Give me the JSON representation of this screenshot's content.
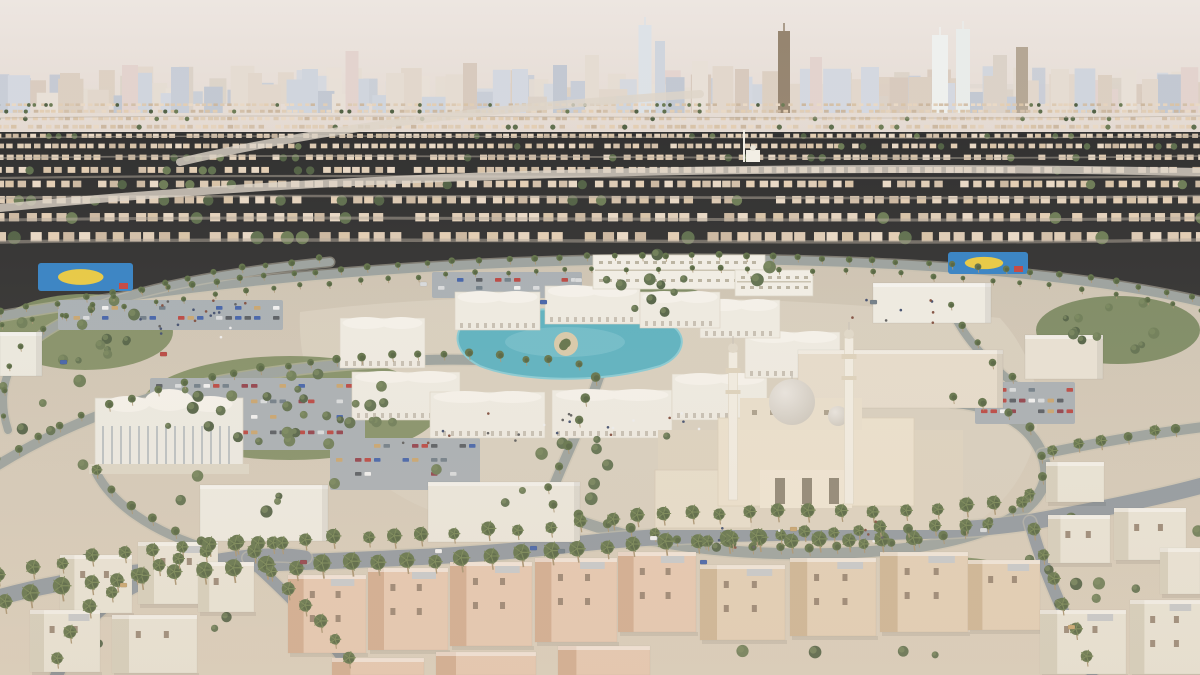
{
  "meta": {
    "description": "Aerial 3D architectural rendering of a Middle-Eastern city district: a community core with a grand mosque, arcaded souq around a turquoise pool, schools, parks, parking lots and palm-lined ring roads, surrounded by low-rise residential sprawl and a high-rise skyline on the horizon",
    "visible_text": "none"
  },
  "palette": {
    "sky_top": "#ede6e1",
    "sky_bot": "#e4dad2",
    "haze": "#ded7cf",
    "skyline": [
      "#c8cdd7",
      "#d4d8e0",
      "#dbd2c8",
      "#e2d7cc",
      "#cfd5dd",
      "#d8cabd",
      "#e5dcd2",
      "#c2c8d2",
      "#dccfc2",
      "#e8e0d7",
      "#e3d3ce"
    ],
    "sand_houses": [
      "#dcc9b2",
      "#e5d3bd",
      "#d2bfa8",
      "#e9d9c5",
      "#cbb79f",
      "#e0cdb6",
      "#d7c2a6",
      "#e3cdb2"
    ],
    "sprawl_street": "#b3aa9b",
    "sprawl_highway": "#ddd5c8",
    "ground_top": "#cdc3b2",
    "ground_bot": "#dbcfbc",
    "plaza": "#d8cfbf",
    "road": "#99a09c",
    "road_fg": "#8f979e",
    "road_edge": "#c6bfae",
    "green": [
      "#75855c",
      "#7d8b60"
    ],
    "tree": [
      "#4e5e41",
      "#5b6c4a",
      "#697952"
    ],
    "tree_hi": "#76865a",
    "palm_crown": "#5d6f45",
    "palm_crown_dark": "#4b5b38",
    "palm_frond": "#71824f",
    "palm_trunk": "#a8926f",
    "pool": "#57b0c0",
    "pool_light": "#84cad4",
    "island_sand": "#d8c9a8",
    "court_blue": "#2f7fc4",
    "court_yellow": "#e8c93e",
    "court_red": "#c2403a",
    "white_b": "#efece3",
    "white_roof": "#f6f3ec",
    "arcade_dark": "#b5ad9c",
    "school_face": "#f2efe7",
    "school_line": "#c9c2b0",
    "mosque_wall": "#ece1cd",
    "mosque_plat": "#ddd2bf",
    "mosque_court": "#e8decb",
    "mosque_dark": "#8d8372",
    "dome_hi": "#e9e5df",
    "dome_lo": "#c9c3b8",
    "minaret": "#f2ede2",
    "minaret_trim": "#ddd2bc",
    "villa_white": "#eae5d7",
    "villa_white_side": "#d6cfbc",
    "villa_pink": "#e7c8b0",
    "villa_pink_side": "#d2ab8e",
    "villa_beige": "#e4cfb5",
    "villa_beige_side": "#ceb493",
    "roofdeck": "#c6c9cb",
    "window": "#8a7663",
    "parking": "#a7aeb3",
    "cars": [
      "#d8dbdd",
      "#b8413c",
      "#3d5ea8",
      "#53585e",
      "#c8a36b",
      "#f2f2f2",
      "#6c7a85",
      "#8e3b46"
    ],
    "people": [
      "#5a5a5a",
      "#7d4a3a",
      "#3c4a6b",
      "#efefef"
    ]
  },
  "scene": {
    "seed": 11,
    "skyline": {
      "bands": [
        {
          "base": 104,
          "step": [
            12,
            24
          ],
          "w": [
            10,
            24
          ],
          "h": [
            12,
            38
          ]
        },
        {
          "base": 113,
          "step": [
            16,
            30
          ],
          "w": [
            14,
            30
          ],
          "h": [
            16,
            48
          ]
        }
      ],
      "towers": [
        [
          70,
          20,
          40
        ],
        [
          130,
          16,
          48
        ],
        [
          180,
          18,
          46
        ],
        [
          255,
          14,
          40
        ],
        [
          310,
          16,
          44
        ],
        [
          352,
          13,
          62
        ],
        [
          395,
          18,
          40
        ],
        [
          470,
          14,
          50
        ],
        [
          520,
          16,
          44
        ],
        [
          560,
          14,
          48
        ],
        [
          592,
          14,
          58
        ],
        [
          645,
          13,
          88,
          "#dde2e7"
        ],
        [
          660,
          10,
          72
        ],
        [
          700,
          16,
          52
        ],
        [
          742,
          14,
          44
        ],
        [
          784,
          12,
          82,
          "#95846f"
        ],
        [
          816,
          12,
          56
        ],
        [
          870,
          18,
          46
        ],
        [
          940,
          16,
          78,
          "#eef0ee"
        ],
        [
          963,
          14,
          84,
          "#e9ecea"
        ],
        [
          1000,
          14,
          58
        ],
        [
          1022,
          12,
          66,
          "#b4a694"
        ],
        [
          1060,
          18,
          44
        ],
        [
          1105,
          14,
          38
        ],
        [
          1150,
          16,
          34
        ]
      ],
      "haze_band": [
        760,
        84,
        440,
        26
      ]
    },
    "sprawl": {
      "y0": 106,
      "y1": 256,
      "streets": [
        118,
        138,
        158,
        178,
        198,
        220,
        242
      ],
      "highways": [
        "M180,162 C350,122 520,106 700,94",
        "M0,208 C300,178 700,162 1200,172"
      ],
      "mini_mosque": [
        746,
        150
      ]
    },
    "ground_d": "M0,322 C250,270 520,254 760,258 C980,262 1120,280 1200,302 L1200,675 L0,675 Z",
    "plaza_d": "M300,312 C480,288 760,292 1000,318 C1058,382 1048,470 980,520 C820,558 600,548 440,514 C340,480 296,390 300,312 Z",
    "parks": [
      [
        85,
        332,
        88,
        38
      ],
      [
        290,
        408,
        150,
        52
      ],
      [
        1118,
        330,
        82,
        34
      ],
      [
        950,
        577,
        70,
        20
      ],
      [
        640,
        300,
        70,
        16
      ]
    ],
    "tree_zones": [
      [
        40,
        540,
        230,
        120,
        10
      ],
      [
        690,
        545,
        320,
        110,
        12
      ],
      [
        1020,
        470,
        180,
        160,
        12
      ],
      [
        180,
        470,
        160,
        70,
        6
      ],
      [
        420,
        452,
        180,
        56,
        6
      ],
      [
        600,
        250,
        190,
        36,
        8
      ],
      [
        0,
        378,
        90,
        90,
        6
      ],
      [
        560,
        430,
        130,
        40,
        5
      ]
    ],
    "roads": [
      {
        "d": "M-10,318 C250,272 520,256 760,260 C980,264 1120,282 1210,304",
        "w": 9
      },
      {
        "d": "M330,262 C150,280 60,310 18,355 C-2,382 2,412 8,430",
        "w": 8
      },
      {
        "d": "M-10,470 C100,400 220,372 380,362 C480,356 540,362 600,374",
        "w": 10
      },
      {
        "d": "M600,374 C585,420 562,462 546,506",
        "w": 10
      },
      {
        "d": "M546,506 C620,546 760,562 890,550 C1000,540 1062,502 1042,454 C1028,420 992,406 952,402",
        "w": 11
      },
      {
        "d": "M1042,454 C1100,442 1160,432 1212,426",
        "w": 10
      },
      {
        "d": "M948,300 C958,332 988,366 1030,396",
        "w": 8
      },
      {
        "d": "M95,470 C110,502 150,532 212,550",
        "w": 9
      },
      {
        "d": "M-10,600 C150,552 350,570 560,546 C760,522 900,542 1030,522 C1120,506 1180,492 1215,482",
        "w": 16,
        "fg": true
      },
      {
        "d": "M55,680 C75,625 110,586 190,566 C240,554 280,553 305,557",
        "w": 13,
        "fg": true
      },
      {
        "d": "M1030,522 C1040,560 1062,612 1092,672",
        "w": 12,
        "fg": true
      },
      {
        "d": "M248,558 C292,598 332,638 354,676",
        "w": 11,
        "fg": true
      }
    ],
    "parking": [
      [
        150,
        378,
        215,
        72,
        4
      ],
      [
        58,
        300,
        225,
        30,
        2
      ],
      [
        432,
        272,
        150,
        26,
        2
      ],
      [
        975,
        382,
        100,
        42,
        3
      ],
      [
        330,
        438,
        150,
        52,
        3
      ]
    ],
    "courts": [
      [
        38,
        263,
        95,
        28
      ],
      [
        948,
        252,
        80,
        22
      ]
    ],
    "pool": {
      "d": "M470,318 C520,306 600,306 660,320 C692,330 686,356 660,366 C600,384 520,382 480,366 C452,352 452,330 470,318 Z",
      "island": [
        566,
        344,
        12
      ]
    },
    "souq": [
      [
        340,
        318,
        85,
        50
      ],
      [
        352,
        372,
        108,
        48
      ],
      [
        430,
        392,
        115,
        46
      ],
      [
        552,
        390,
        120,
        48
      ],
      [
        672,
        374,
        95,
        46
      ],
      [
        745,
        332,
        95,
        46
      ],
      [
        700,
        300,
        80,
        38
      ],
      [
        455,
        292,
        85,
        38
      ],
      [
        545,
        286,
        95,
        38
      ],
      [
        640,
        292,
        80,
        36
      ]
    ],
    "buildings": [
      {
        "r": [
          593,
          255,
          172,
          34
        ],
        "t": "school"
      },
      {
        "r": [
          735,
          270,
          78,
          26
        ],
        "t": "school"
      },
      {
        "r": [
          873,
          283,
          118,
          40
        ],
        "t": "box",
        "c": "#efece3"
      },
      {
        "r": [
          798,
          350,
          205,
          58
        ],
        "t": "box",
        "c": "#e6dccb"
      },
      {
        "r": [
          1025,
          335,
          78,
          44
        ],
        "t": "box",
        "c": "#e9e2d4"
      },
      {
        "r": [
          95,
          398,
          148,
          72
        ],
        "t": "civic"
      },
      {
        "r": [
          200,
          485,
          128,
          56
        ],
        "t": "box",
        "c": "#efece2"
      },
      {
        "r": [
          428,
          482,
          152,
          60
        ],
        "t": "box",
        "c": "#ece8dd"
      },
      {
        "r": [
          660,
          444,
          30,
          22
        ],
        "t": "box",
        "c": "#e8e2d4"
      },
      {
        "r": [
          0,
          332,
          42,
          44
        ],
        "t": "box",
        "c": "#eceae0"
      }
    ],
    "mosque": {
      "platform": [
        658,
        430,
        305,
        100
      ],
      "court": [
        655,
        470,
        96,
        58
      ],
      "hall": [
        718,
        418,
        196,
        88
      ],
      "facade": [
        760,
        470,
        92,
        38
      ],
      "upper": [
        740,
        398,
        122,
        32
      ],
      "dome": [
        792,
        402,
        23
      ],
      "half_dome": [
        838,
        416,
        10
      ],
      "minarets": [
        [
          733,
          352,
          148
        ],
        [
          849,
          338,
          166
        ]
      ]
    },
    "villas": [
      {
        "r": [
          60,
          555,
          72,
          58
        ],
        "t": "white"
      },
      {
        "r": [
          138,
          542,
          80,
          62
        ],
        "t": "white"
      },
      {
        "r": [
          30,
          610,
          70,
          62
        ],
        "t": "white"
      },
      {
        "r": [
          112,
          615,
          85,
          58
        ],
        "t": "white"
      },
      {
        "r": [
          198,
          562,
          56,
          50
        ],
        "t": "white"
      },
      {
        "r": [
          288,
          575,
          78,
          78
        ],
        "t": "pink"
      },
      {
        "r": [
          368,
          568,
          80,
          82
        ],
        "t": "pink"
      },
      {
        "r": [
          450,
          562,
          82,
          84
        ],
        "t": "pink"
      },
      {
        "r": [
          535,
          558,
          82,
          84
        ],
        "t": "pink"
      },
      {
        "r": [
          618,
          552,
          78,
          80
        ],
        "t": "pink"
      },
      {
        "r": [
          332,
          658,
          92,
          17
        ],
        "t": "pink"
      },
      {
        "r": [
          436,
          652,
          100,
          23
        ],
        "t": "pink"
      },
      {
        "r": [
          558,
          646,
          92,
          29
        ],
        "t": "pink"
      },
      {
        "r": [
          700,
          565,
          85,
          75
        ],
        "t": "beige"
      },
      {
        "r": [
          790,
          558,
          86,
          78
        ],
        "t": "beige"
      },
      {
        "r": [
          880,
          552,
          88,
          80
        ],
        "t": "beige"
      },
      {
        "r": [
          968,
          560,
          72,
          70
        ],
        "t": "beige"
      },
      {
        "r": [
          1048,
          515,
          62,
          48
        ],
        "t": "white"
      },
      {
        "r": [
          1114,
          508,
          72,
          52
        ],
        "t": "white"
      },
      {
        "r": [
          1040,
          610,
          86,
          64
        ],
        "t": "white"
      },
      {
        "r": [
          1130,
          600,
          72,
          74
        ],
        "t": "white"
      },
      {
        "r": [
          1160,
          548,
          40,
          46
        ],
        "t": "white"
      },
      {
        "r": [
          1046,
          462,
          58,
          40
        ],
        "t": "white"
      }
    ],
    "palm_rows": [
      {
        "d": "M-10,318 C250,272 520,256 760,260 C980,264 1120,282 1210,304",
        "step": 27,
        "r": 3.1
      },
      {
        "d": "M-10,330 C250,284 520,268 760,272 C980,276 1120,294 1210,316",
        "step": 30,
        "r": 2.6
      },
      {
        "d": "M330,262 C150,280 60,310 18,355 C-2,382 2,412 8,430",
        "step": 27,
        "r": 3
      },
      {
        "d": "M-10,470 C100,400 220,372 380,362 C480,356 540,362 600,374",
        "step": 26,
        "r": 3.8
      },
      {
        "d": "M600,374 C585,420 562,462 546,506",
        "step": 24,
        "r": 4.2
      },
      {
        "d": "M546,506 C620,546 760,562 890,550 C1000,540 1062,502 1042,454 C1028,420 992,406 952,402",
        "step": 26,
        "r": 4.4
      },
      {
        "d": "M948,300 C958,332 988,366 1030,396",
        "step": 24,
        "r": 3.4
      },
      {
        "d": "M95,470 C110,502 150,532 212,550",
        "step": 24,
        "r": 4.4
      },
      {
        "d": "M-10,588 C150,540 350,558 560,534 C760,510 900,530 1036,510",
        "step": 30,
        "r": 6.2
      },
      {
        "d": "M-6,616 C150,568 350,586 560,562 C700,546 820,556 940,548",
        "step": 29,
        "r": 7.5
      },
      {
        "d": "M55,676 C78,622 112,584 192,564 C242,552 282,551 305,555",
        "step": 26,
        "r": 6.2
      },
      {
        "d": "M1032,528 C1042,564 1064,614 1092,670",
        "step": 27,
        "r": 6
      },
      {
        "d": "M248,556 C292,598 332,638 354,676",
        "step": 25,
        "r": 6
      },
      {
        "d": "M1042,460 C1100,448 1160,438 1212,432",
        "step": 26,
        "r": 5
      },
      {
        "d": "M700,550 C800,540 900,536 1000,532",
        "step": 26,
        "r": 5.6
      }
    ],
    "cars": [
      [
        435,
        549
      ],
      [
        530,
        546
      ],
      [
        558,
        549
      ],
      [
        300,
        560
      ],
      [
        650,
        536
      ],
      [
        790,
        527
      ],
      [
        120,
        583
      ],
      [
        980,
        528
      ],
      [
        540,
        300
      ],
      [
        420,
        282
      ],
      [
        575,
        278
      ],
      [
        1068,
        625
      ],
      [
        160,
        352
      ],
      [
        60,
        360
      ],
      [
        700,
        560
      ],
      [
        870,
        300
      ]
    ],
    "people_zones": [
      [
        140,
        300,
        110,
        40,
        18
      ],
      [
        400,
        408,
        300,
        36,
        22
      ],
      [
        700,
        520,
        200,
        30,
        10
      ],
      [
        840,
        300,
        120,
        24,
        8
      ]
    ]
  }
}
